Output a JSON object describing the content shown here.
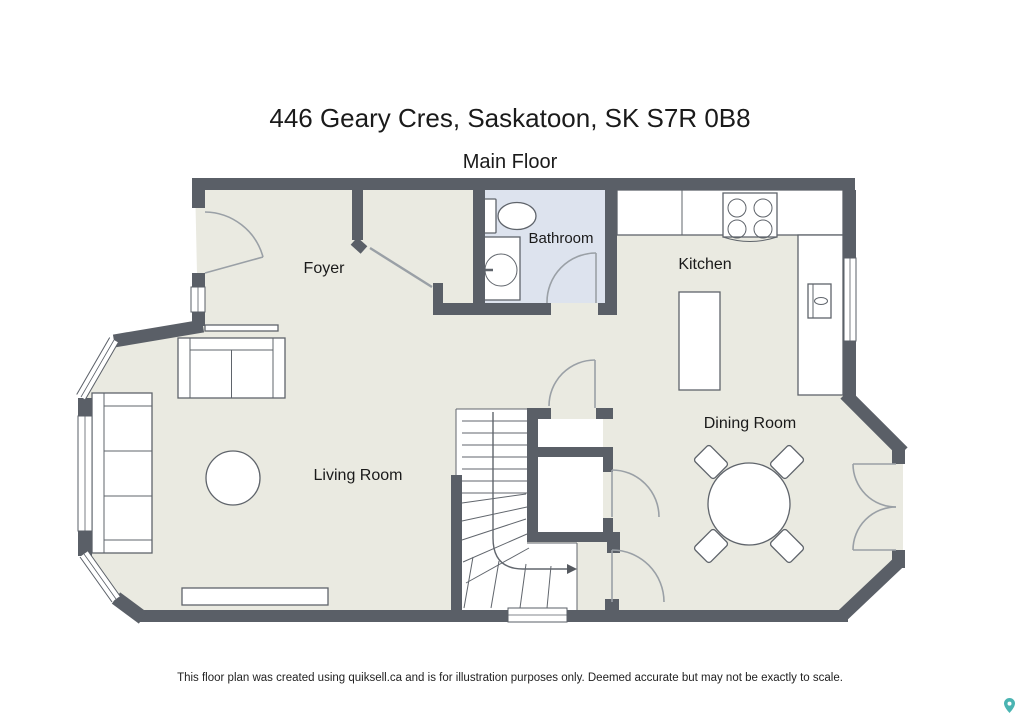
{
  "page": {
    "title": "446 Geary Cres, Saskatoon, SK S7R 0B8",
    "subtitle": "Main Floor",
    "disclaimer": "This floor plan was created using quiksell.ca and is for illustration purposes only. Deemed accurate but may not be exactly to scale."
  },
  "rooms": {
    "foyer": "Foyer",
    "bathroom": "Bathroom",
    "kitchen": "Kitchen",
    "living_room": "Living Room",
    "dining_room": "Dining Room"
  },
  "fixtures": [
    "entry-door",
    "toilet",
    "bathroom-sink-vanity",
    "stove",
    "kitchen-counter",
    "kitchen-island",
    "kitchen-sink",
    "staircase",
    "stair-direction-arrow",
    "closets",
    "dining-table",
    "dining-chairs",
    "french-doors",
    "sofa",
    "loveseat",
    "coffee-table",
    "media-console",
    "bay-windows"
  ],
  "colors": {
    "floor": "#eaeae1",
    "bathroom_floor": "#dde3ee",
    "wall": "#5a5f67",
    "furniture_outline": "#5f646b",
    "door_swing": "#9aa0a6",
    "text": "#1a1a1a",
    "watermark_teal": "#2ba7a5"
  }
}
